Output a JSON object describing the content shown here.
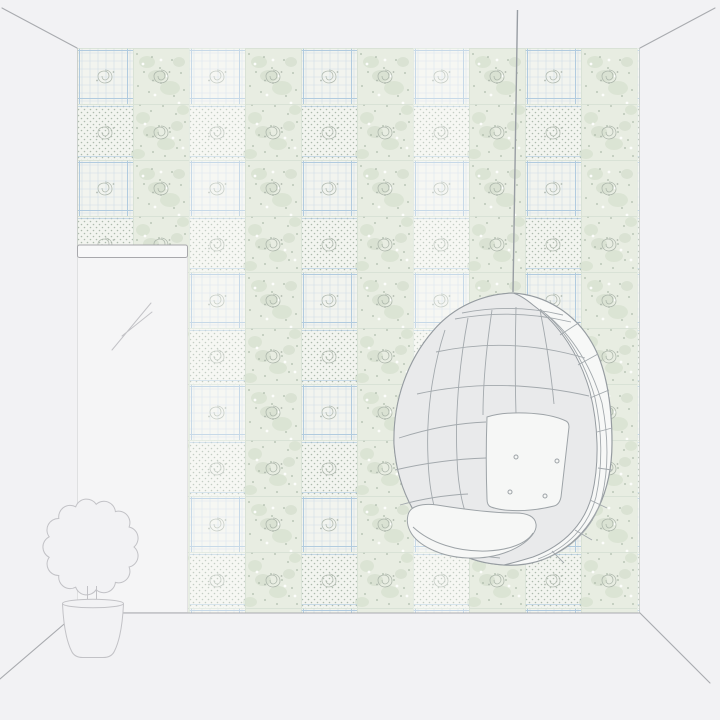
{
  "scene": {
    "canvas": {
      "width": 720,
      "height": 720
    },
    "room": {
      "background": "#f2f2f4",
      "edge_line": "#a9abaf",
      "corner_line": "#c8ccc9"
    },
    "wallpaper": {
      "base": "#f2f4ef",
      "floral_band": "#e8ede2",
      "blob": "#d9e2d1",
      "blob2": "#cdd9c7",
      "speckle": "#9fae9d",
      "flower_white": "#fcfdfb",
      "plaid_line": "#ccdae6",
      "plaid_accent": "#aac7de",
      "dot": "#aebbad",
      "seam": "#d6e0d3",
      "rose": "#a9b3a8"
    },
    "mirror": {
      "frame_stroke": "#a8a8ac",
      "frame_fill": "#f8f8f9",
      "glass_fill": "#f5f5f6",
      "glass_edge": "#dfdfe2",
      "reflection_line": "#c3c3c7"
    },
    "plant": {
      "line": "#c2c2c6",
      "fill": "#f2f2f4"
    },
    "chair": {
      "cord": "#989da3",
      "outline": "#969ca1",
      "lattice": "#a3a9ad",
      "shell_fill": "#e9eaeb",
      "band_fill": "#f7f8f7",
      "cushion_fill": "#f6f7f6",
      "cushion_line": "#9da3a7"
    }
  }
}
